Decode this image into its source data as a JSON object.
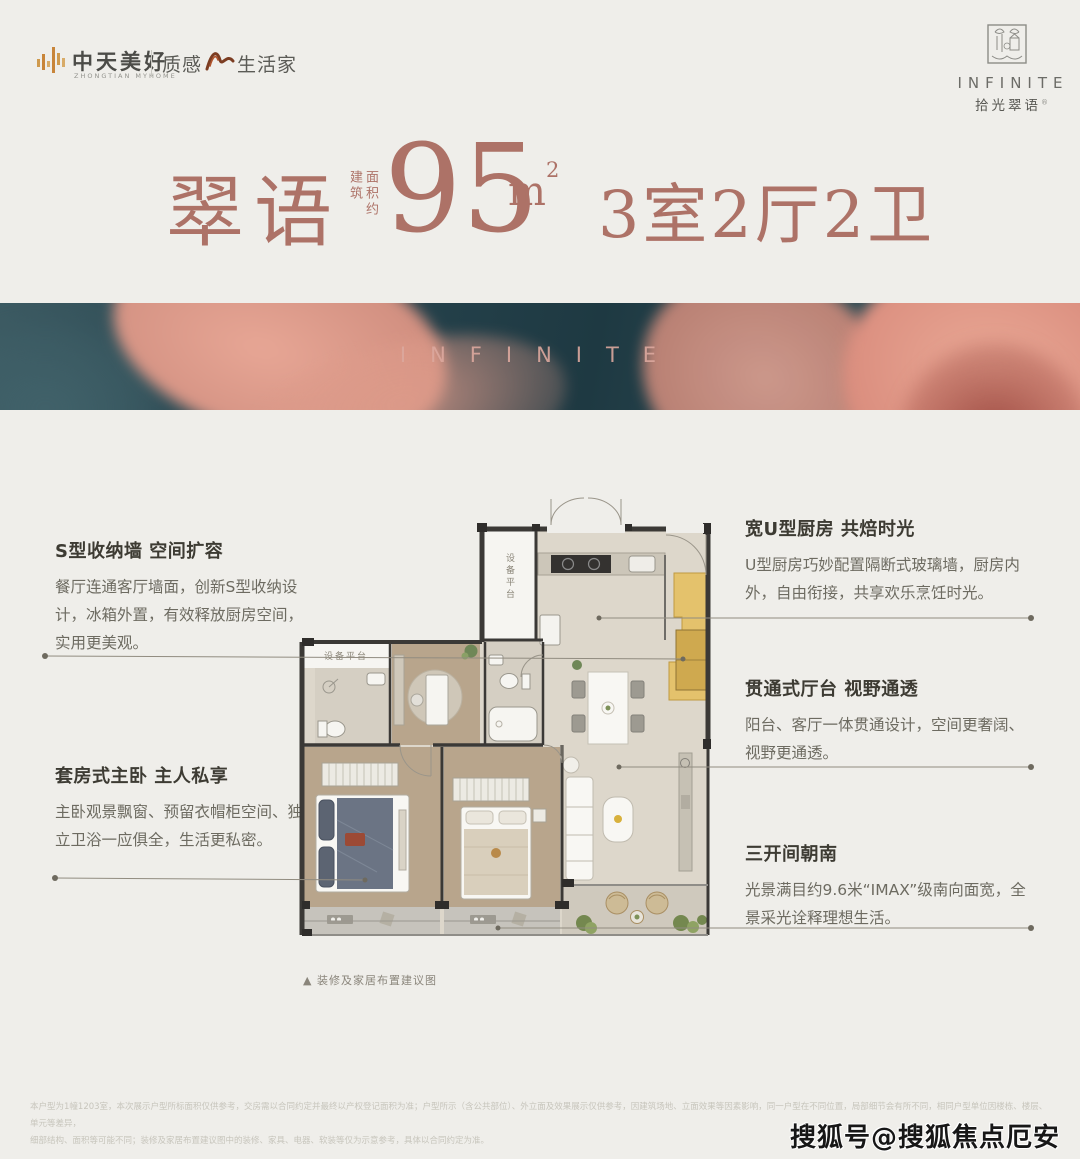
{
  "brand": {
    "name": "中天美好",
    "name_en": "ZHONGTIAN MYHOME",
    "tagline_left": "质感",
    "tagline_right": "生活家"
  },
  "project_logo": {
    "name_en": "INFINITE",
    "name_cn": "拾光翠语",
    "trademark": "®"
  },
  "headline": {
    "name": "翠语",
    "area_prefix_col1": "建筑",
    "area_prefix_col2": "面积约",
    "area_value": "95",
    "area_unit_base": "m",
    "area_unit_sup": "2",
    "rooms": "3室2厅2卫"
  },
  "banner": {
    "watermark_text": "INFINITE"
  },
  "floorplan": {
    "equipment_platform_top": "设备平台",
    "equipment_platform_left": "设备平台",
    "caption": "▲ 装修及家居布置建议图"
  },
  "features_left": [
    {
      "title": "S型收纳墙 空间扩容",
      "body": "餐厅连通客厅墙面，创新S型收纳设计，冰箱外置，有效释放厨房空间，实用更美观。"
    },
    {
      "title": "套房式主卧 主人私享",
      "body": "主卧观景飘窗、预留衣帽柜空间、独立卫浴一应俱全，生活更私密。"
    }
  ],
  "features_right": [
    {
      "title": "宽U型厨房 共焙时光",
      "body": "U型厨房巧妙配置隔断式玻璃墙，厨房内外，自由衔接，共享欢乐烹饪时光。"
    },
    {
      "title": "贯通式厅台 视野通透",
      "body": "阳台、客厅一体贯通设计，空间更奢阔、视野更通透。"
    },
    {
      "title": "三开间朝南",
      "body": "光景满目约9.6米“IMAX”级南向面宽，全景采光诠释理想生活。"
    }
  ],
  "footer": {
    "disclaimer_line1": "本户型为1幢1203室，本次展示户型所标面积仅供参考，交房需以合同约定并最终以产权登记面积为准；户型所示（含公共部位）、外立面及效果展示仅供参考，因建筑场地、立面效果等因素影响，同一户型在不同位置，局部细节会有所不同，相同户型单位因楼栋、楼层、单元等差异，",
    "disclaimer_line2": "细部结构、面积等可能不同；装修及家居布置建议图中的装修、家具、电器、软装等仅为示意参考，具体以合同约定为准。",
    "watermark": "搜狐号@搜狐焦点厄安站"
  },
  "colors": {
    "accent": "#ad7267",
    "highlight": "#e4c26c",
    "banner_teal": "#27444e",
    "petal_pink": "#dd9b8a"
  }
}
